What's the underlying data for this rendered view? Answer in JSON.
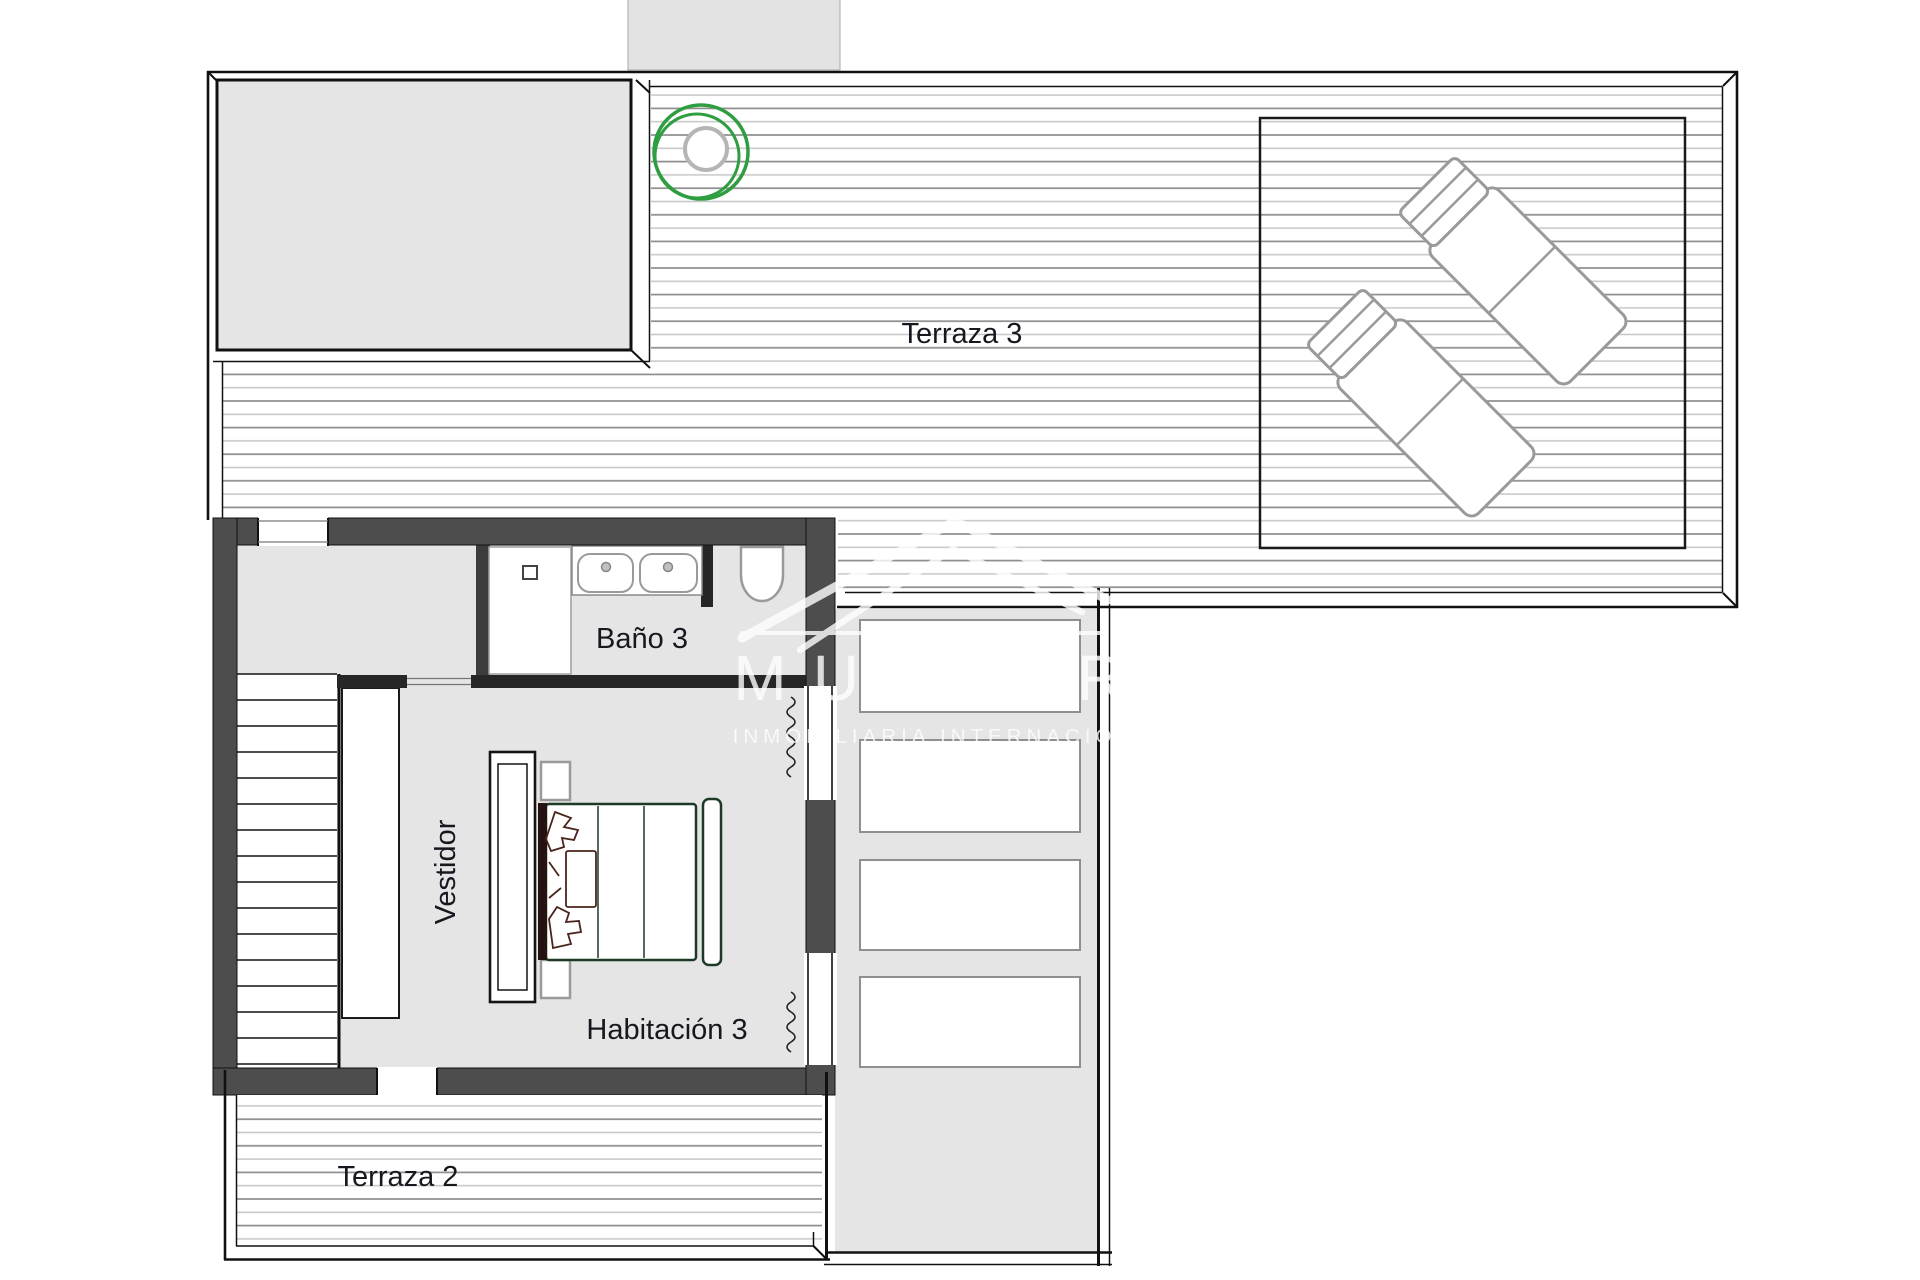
{
  "plan": {
    "areas": {
      "terraza3": {
        "label": "Terraza 3"
      },
      "bano3": {
        "label": "Baño 3"
      },
      "vestidor": {
        "label": "Vestidor"
      },
      "habitacion3": {
        "label": "Habitación 3"
      },
      "terraza2": {
        "label": "Terraza 2"
      }
    }
  },
  "watermark": {
    "letter_m": "M",
    "letter_u": "U",
    "letter_r": "R",
    "subtext": "INMOBILIARIA INTERNACIONAL"
  },
  "colors": {
    "page_bg": "#ffffff",
    "floor": "#e5e5e5",
    "block": "#e3e3e3",
    "wall": "#4d4d4d",
    "partition": "#262626",
    "line": "#111111",
    "deck_dark": "#8c8c8c",
    "deck_light": "#c6c6c6",
    "fixture": "#9a9a9a",
    "box_border": "#8f8f8f",
    "accent_green": "#2f9e41",
    "bed_green": "#1d3a26",
    "pillow_brown": "#4a241a",
    "label": "#17171f",
    "watermark": "#ffffff"
  }
}
